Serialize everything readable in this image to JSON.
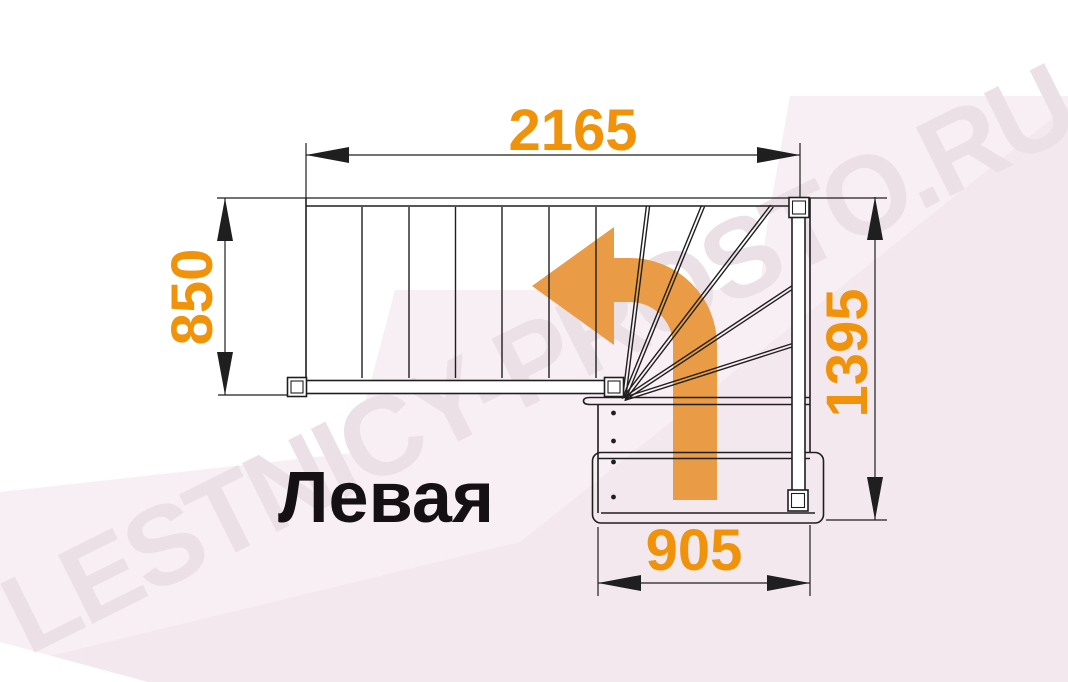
{
  "diagram": {
    "type_label": "Левая",
    "watermark": "LESTNICY-PROSTO.RU",
    "dimensions": {
      "top_width_mm": "2165",
      "flight_width_mm": "850",
      "right_height_mm": "1395",
      "bottom_width_mm": "905"
    },
    "colors": {
      "dimension_text": "#F0930B",
      "arrow": "#E99C45",
      "line": "#1F1F1F",
      "label_text": "#141014",
      "background_pink": "#F8EFF4",
      "background_pink_deep": "#F3E8EE",
      "watermark": "#ECE0E7"
    }
  }
}
